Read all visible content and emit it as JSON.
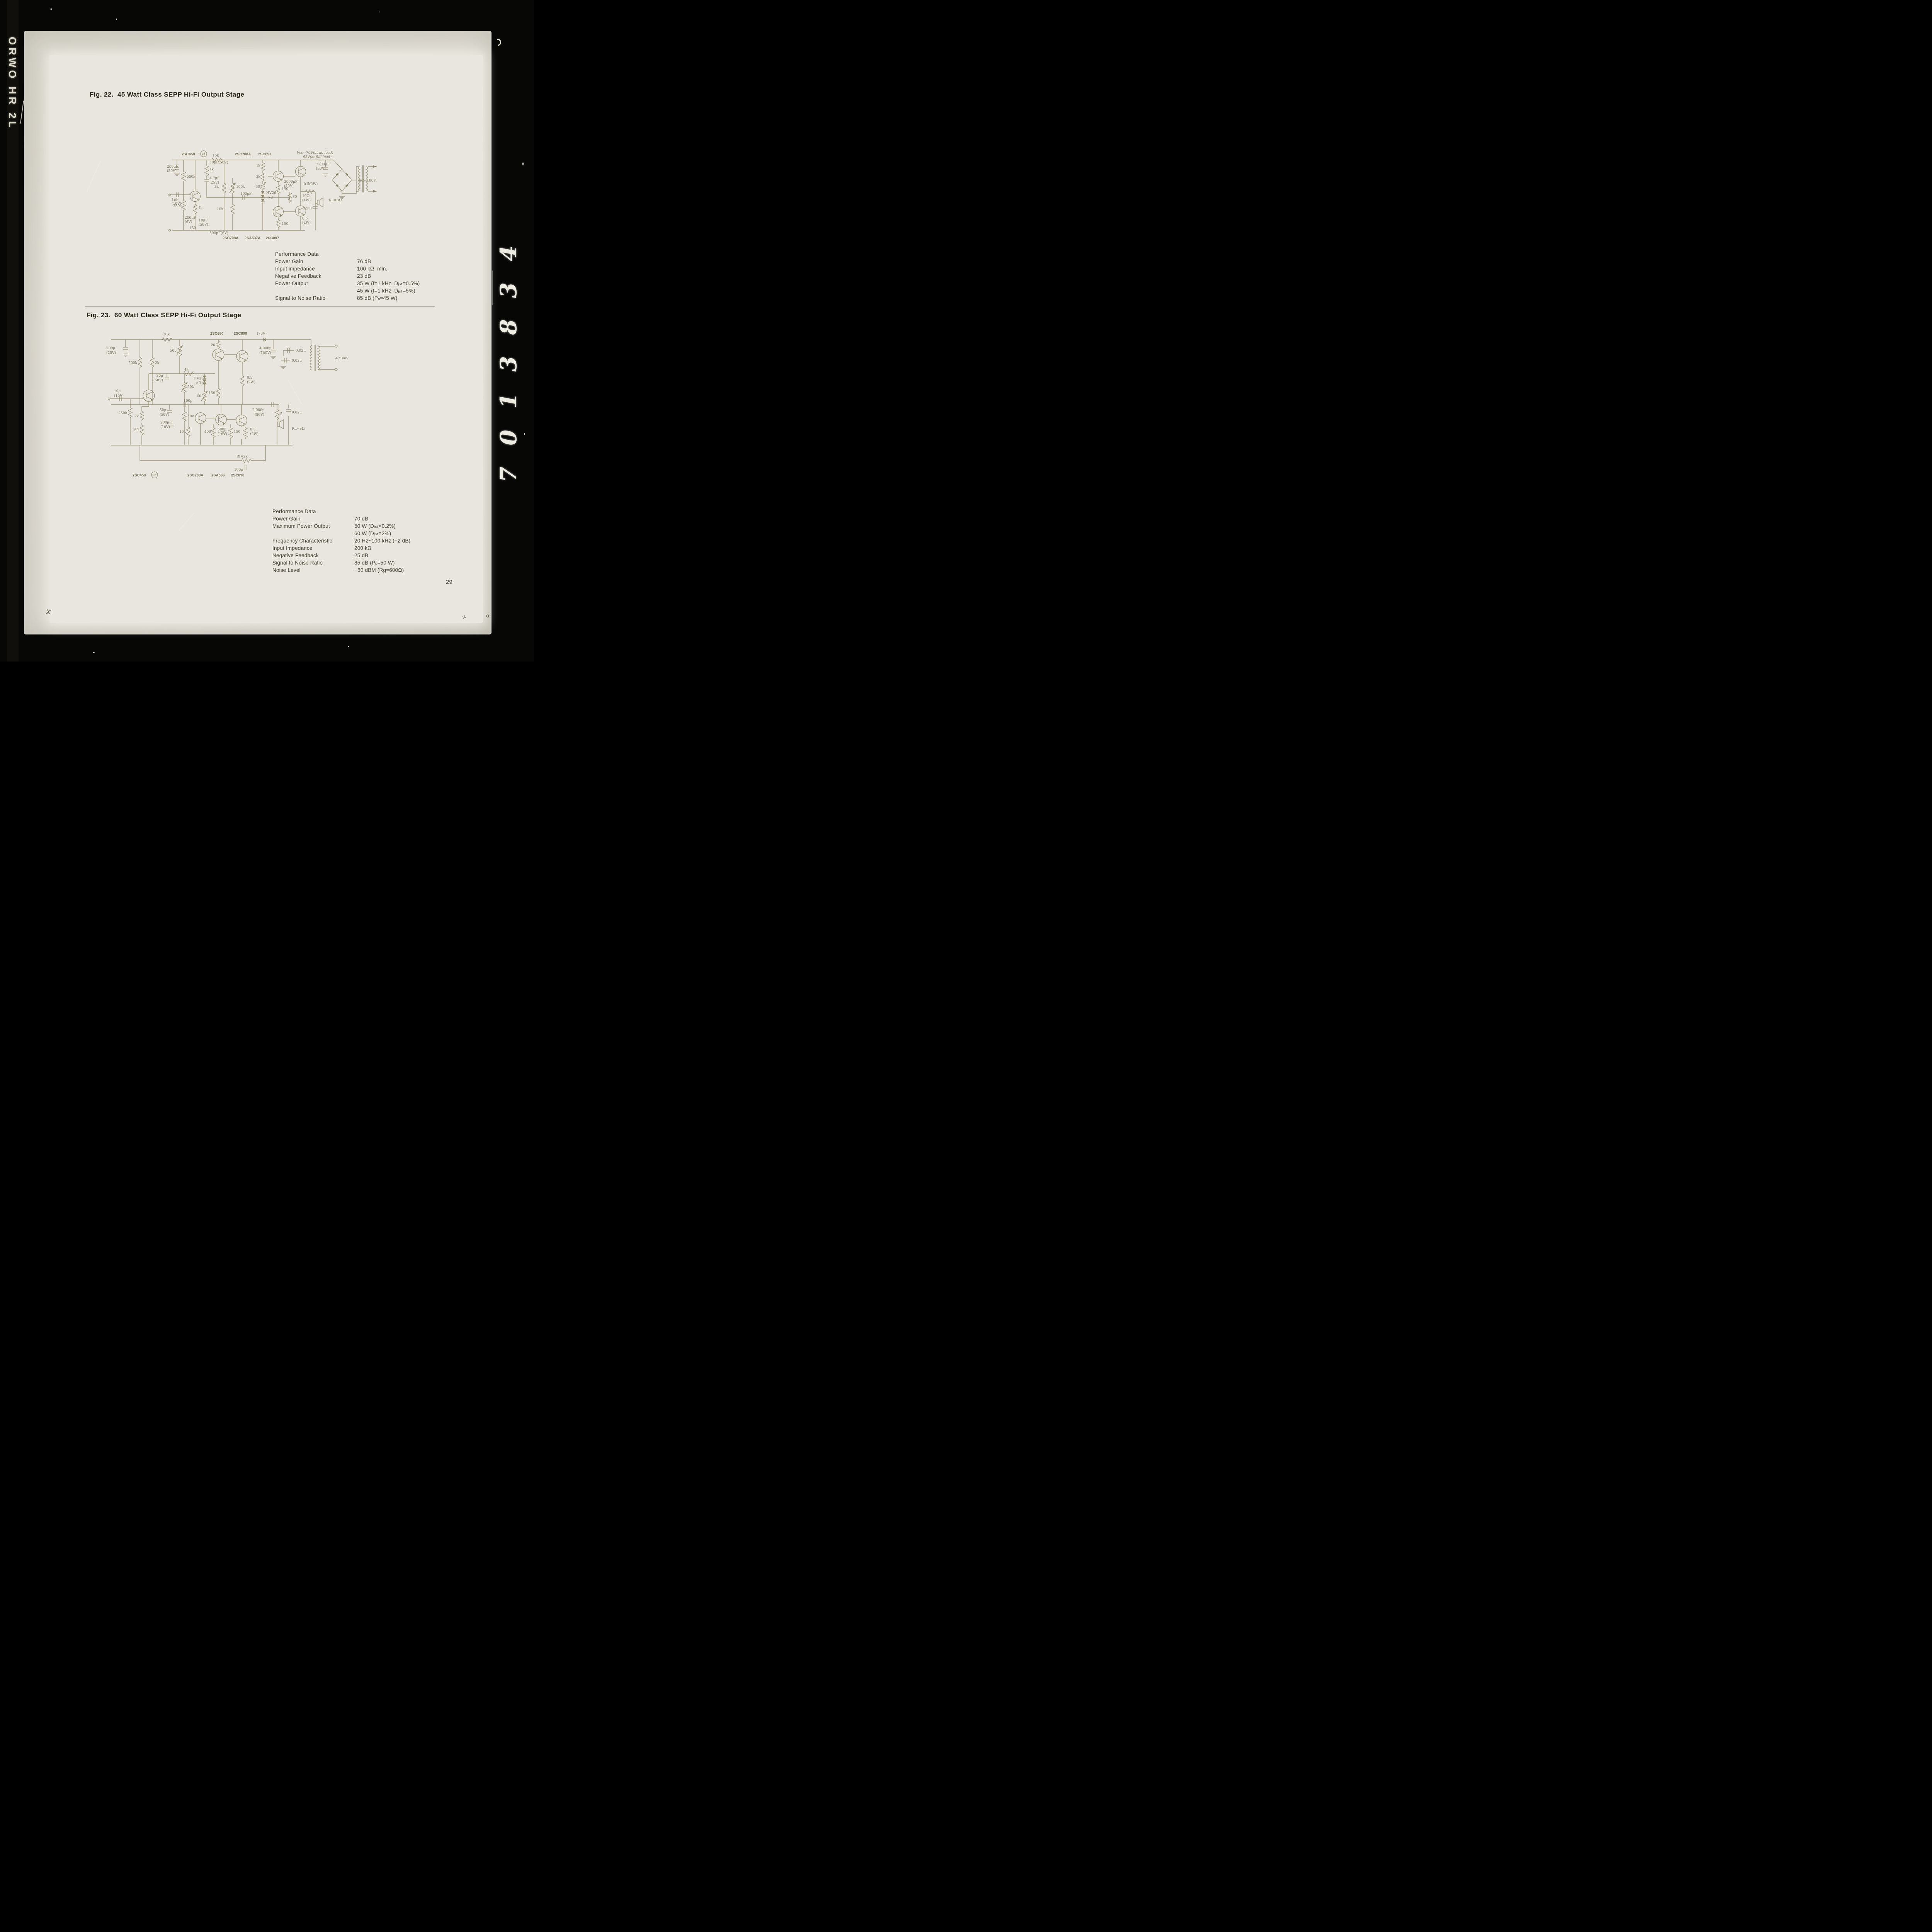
{
  "film": {
    "edge_left": "ORWO HR 2L",
    "edge_right": "7013834"
  },
  "page": {
    "number": "29",
    "mark_x": "x",
    "mark_plus": "+",
    "mark_o": "o"
  },
  "fig22": {
    "title": "Fig. 22.  45 Watt Class SEPP Hi-Fi Output Stage",
    "schematic": {
      "top": {
        "q_in": "2SC458",
        "l6": "L6",
        "r15k": "15k",
        "q_drv": "2SC708A",
        "q_out": "2SC897"
      },
      "vcc1": "Vcc=70V(at no load)",
      "vcc2": "62V(at full load)",
      "ac": "AC=100V",
      "load": "RL=8Ω",
      "bottom": {
        "b1": "2SC708A",
        "b2": "2SA537A",
        "b3": "2SC897"
      },
      "c": {
        "c200_50": "200μF",
        "c200_50v": "(50V)",
        "r500k": "500k",
        "c1u": "1μF",
        "c1uv": "(10V)",
        "r250k": "250k",
        "c50u": "50μF(50V)",
        "r1k_a": "1k",
        "c47": "4.7μF",
        "c47v": "(25V)",
        "r1k_b": "1k",
        "c200_6": "200μF",
        "c200_6v": "(6V)",
        "c10u": "10μF",
        "c10uv": "(50V)",
        "r150_in": "150",
        "c500u": "500μF(6V)",
        "r3k": "3k",
        "r100k": "100k",
        "c100p": "100pF",
        "r10k": "10k",
        "r1k_c": "1k",
        "r2k": "2k",
        "r50": "50",
        "hv": "HV26",
        "x3": "×3",
        "r150_a": "150",
        "r30": "30",
        "r150_b": "150",
        "c2000": "2000μF",
        "c2000v": "(40V)",
        "r05a": "0.5(2W)",
        "r10ohm": "10Ω",
        "r10ohmv": "(1W)",
        "c05": "0.5μF",
        "r05b": "0.5",
        "r05bv": "(2W)",
        "c2200": "2200μF",
        "c2200v": "(80V)"
      }
    },
    "performance": {
      "heading": "Performance Data",
      "rows": [
        {
          "label": "Power Gain",
          "value": "76 dB"
        },
        {
          "label": "Input impedance",
          "value": "100 kΩ  min."
        },
        {
          "label": "Negative Feedback",
          "value": "23 dB"
        },
        {
          "label": "Power Output",
          "value": "35 W (f=1 kHz, Dᵢₛₜ=0.5%)"
        },
        {
          "label": "",
          "value": "45 W (f=1 kHz, Dᵢₛₜ=5%)"
        },
        {
          "label": "Signal to Noise Ratio",
          "value": "85 dB (Pₒ=45 W)"
        }
      ]
    }
  },
  "fig23": {
    "title": "Fig. 23.  60 Watt Class SEPP Hi-Fi Output Stage",
    "schematic": {
      "top": {
        "q_a": "2SC680",
        "q_b": "2SC898",
        "v76": "(76V)"
      },
      "ac": "AC100V",
      "load": "RL=8Ω",
      "rf": "Rf=2k",
      "bottom": {
        "b1": "2SC458",
        "l6": "L6",
        "b2": "2SC708A",
        "b3": "2SA566",
        "b4": "2SC898"
      },
      "c": {
        "r20k": "20k",
        "c200": "200μ",
        "c200v": "(25V)",
        "r500k": "500k",
        "r2k": "2k",
        "c30": "30μ",
        "c30v": "(50V)",
        "r500": "500",
        "r4k": "4k",
        "hv": "HV26",
        "x3": "×3",
        "r60": "60",
        "r150a": "150",
        "r20a": "20",
        "c4000": "4,000μ",
        "c4000v": "(100V)",
        "c002a": "0.02μ",
        "c002b": "0.02μ",
        "r05a": "0.5",
        "r05av": "(2W)",
        "c10": "10μ",
        "c10v": "(10V)",
        "r250k": "250k",
        "r2k2": "2k",
        "r150b": "150",
        "c50": "50μ",
        "c50v": "(50V)",
        "c200f": "200μF",
        "c200fv": "(10V)",
        "r50ka": "50k",
        "r50kb": "50k",
        "c100pa": "100p",
        "r10k": "10k",
        "r400": "400",
        "c500": "500μ",
        "c500v": "(10V)",
        "r150c": "150",
        "r05b": "0.5",
        "r05bv": "(2W)",
        "c002c": "0.02μ",
        "c2000": "2,000μ",
        "c2000v": "(80V)",
        "r5": "5",
        "c100pb": "100p"
      }
    },
    "performance": {
      "heading": "Performance Data",
      "rows": [
        {
          "label": "Power Gain",
          "value": "70 dB"
        },
        {
          "label": "Maximum Power Output",
          "value": "50 W (Dᵢₛₜ=0.2%)"
        },
        {
          "label": "",
          "value": "60 W (Dᵢₛₜ=2%)"
        },
        {
          "label": "Frequency Characteristic",
          "value": "20 Hz~100 kHz (−2 dB)"
        },
        {
          "label": "Input Impedance",
          "value": "200 kΩ"
        },
        {
          "label": "Negative Feedback",
          "value": "25 dB"
        },
        {
          "label": "Signal to Noise Ratio",
          "value": "85 dB (Pₒ=50 W)"
        },
        {
          "label": "Noise Level",
          "value": "−80 dBM (Rg=600Ω)"
        }
      ]
    }
  }
}
